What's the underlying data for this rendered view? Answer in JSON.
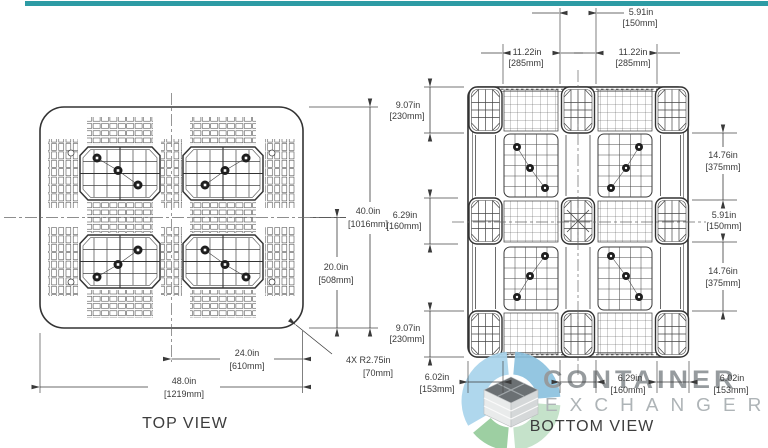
{
  "page": {
    "top_bar_color": "#2d9ba4",
    "background": "#ffffff",
    "drawing_line_color": "#3c3c3c"
  },
  "top_view": {
    "label": "TOP VIEW",
    "dims": {
      "height_in": "40.0in",
      "height_mm": "[1016mm]",
      "half_height_in": "20.0in",
      "half_height_mm": "[508mm]",
      "half_width_in": "24.0in",
      "half_width_mm": "[610mm]",
      "width_in": "48.0in",
      "width_mm": "[1219mm]",
      "corner_radius_in": "4X  R2.75in",
      "corner_radius_mm": "[70mm]"
    }
  },
  "bottom_view": {
    "label": "BOTTOM VIEW",
    "dims": {
      "top_center_in": "5.91in",
      "top_center_mm": "[150mm]",
      "top_left_in": "11.22in",
      "top_left_mm": "[285mm]",
      "top_right_in": "11.22in",
      "top_right_mm": "[285mm]",
      "left_top_in": "9.07in",
      "left_top_mm": "[230mm]",
      "left_middle_in": "6.29in",
      "left_middle_mm": "[160mm]",
      "left_bottom_in": "9.07in",
      "left_bottom_mm": "[230mm]",
      "right_top_in": "14.76in",
      "right_top_mm": "[375mm]",
      "right_middle_in": "5.91in",
      "right_middle_mm": "[150mm]",
      "right_bottom_in": "14.76in",
      "right_bottom_mm": "[375mm]",
      "bottom_left_in": "6.02in",
      "bottom_left_mm": "[153mm]",
      "bottom_center_in": "6.29in",
      "bottom_center_mm": "[160mm]",
      "bottom_right_in": "6.02in",
      "bottom_right_mm": "[153mm]"
    }
  },
  "watermark": {
    "line1": "CONTAINER",
    "line2": "EXCHANGER",
    "text_color": "#8e9396",
    "swirl_colors": {
      "top_left": "#a9d4ec",
      "top_right": "#8cc2df",
      "bottom_right": "#c1e0c6",
      "bottom_left": "#95cb9b"
    }
  }
}
